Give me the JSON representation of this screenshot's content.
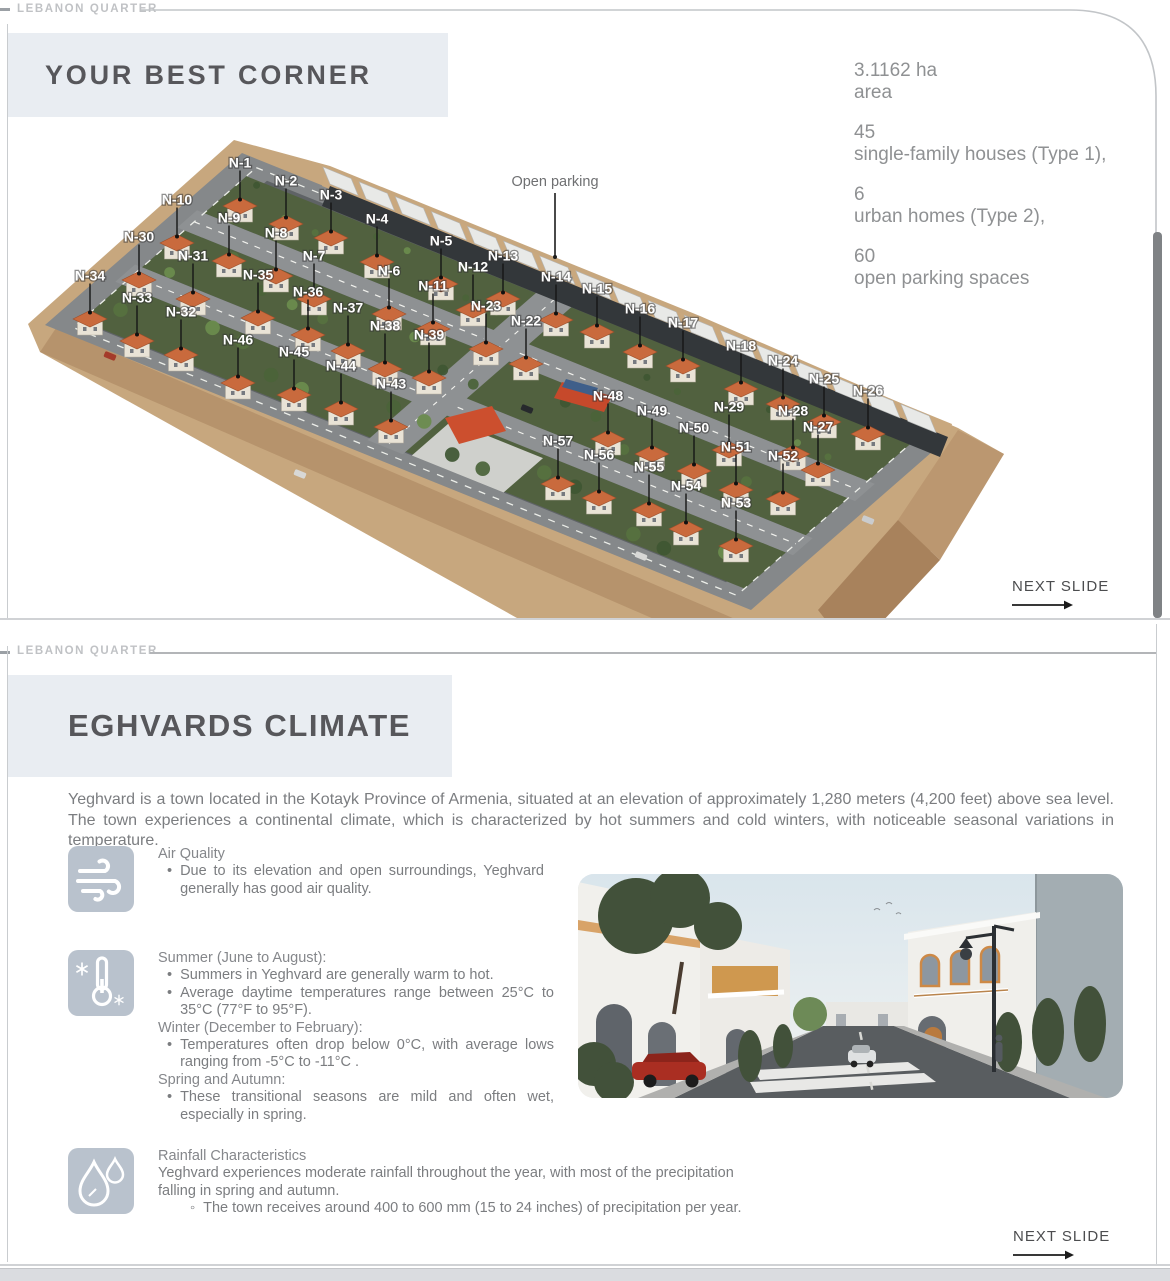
{
  "colors": {
    "title-box-bg": "#e9edf2",
    "brand-text": "#c0c2c5",
    "frame-line": "#c9cccf",
    "heading-text": "#57575b",
    "stats-text": "#8f9193",
    "body-text": "#7b7d80",
    "icon-box-bg": "#b9c2cd",
    "roof-orange": "#c96a3d",
    "terrain-tan": "#c7a77e",
    "asphalt-gray": "#5f6366",
    "scrollbar": "#7f8285",
    "next-slide-text": "#4c4d4f"
  },
  "slide1": {
    "brand": "LEBANON QUARTER",
    "title": "YOUR BEST CORNER",
    "stats": [
      {
        "value": "3.1162 ha",
        "label": "area"
      },
      {
        "value": "45",
        "label": "single-family houses (Type 1),"
      },
      {
        "value": "6",
        "label": "urban homes (Type 2),"
      },
      {
        "value": "60",
        "label": "open parking spaces"
      }
    ],
    "map": {
      "annotation": "Open parking",
      "lots": [
        {
          "label": "N-1",
          "x": 240,
          "y": 163
        },
        {
          "label": "N-10",
          "x": 177,
          "y": 200
        },
        {
          "label": "N-2",
          "x": 286,
          "y": 181
        },
        {
          "label": "N-3",
          "x": 331,
          "y": 195
        },
        {
          "label": "N-9",
          "x": 229,
          "y": 218
        },
        {
          "label": "N-4",
          "x": 377,
          "y": 219
        },
        {
          "label": "N-8",
          "x": 276,
          "y": 233
        },
        {
          "label": "N-30",
          "x": 139,
          "y": 237
        },
        {
          "label": "N-5",
          "x": 441,
          "y": 241
        },
        {
          "label": "N-31",
          "x": 193,
          "y": 256
        },
        {
          "label": "N-7",
          "x": 314,
          "y": 256
        },
        {
          "label": "N-13",
          "x": 503,
          "y": 256
        },
        {
          "label": "N-12",
          "x": 473,
          "y": 267
        },
        {
          "label": "N-6",
          "x": 389,
          "y": 271
        },
        {
          "label": "N-35",
          "x": 258,
          "y": 275
        },
        {
          "label": "N-34",
          "x": 90,
          "y": 276
        },
        {
          "label": "N-14",
          "x": 556,
          "y": 277
        },
        {
          "label": "N-11",
          "x": 433,
          "y": 286
        },
        {
          "label": "N-15",
          "x": 597,
          "y": 289
        },
        {
          "label": "N-36",
          "x": 308,
          "y": 292
        },
        {
          "label": "N-33",
          "x": 137,
          "y": 298
        },
        {
          "label": "N-23",
          "x": 486,
          "y": 306
        },
        {
          "label": "N-37",
          "x": 348,
          "y": 308
        },
        {
          "label": "N-16",
          "x": 640,
          "y": 309
        },
        {
          "label": "N-32",
          "x": 181,
          "y": 312
        },
        {
          "label": "N-22",
          "x": 526,
          "y": 321
        },
        {
          "label": "N-17",
          "x": 683,
          "y": 323
        },
        {
          "label": "N-38",
          "x": 385,
          "y": 326
        },
        {
          "label": "N-39",
          "x": 429,
          "y": 335
        },
        {
          "label": "N-46",
          "x": 238,
          "y": 340
        },
        {
          "label": "N-18",
          "x": 741,
          "y": 346
        },
        {
          "label": "N-45",
          "x": 294,
          "y": 352
        },
        {
          "label": "N-24",
          "x": 783,
          "y": 361
        },
        {
          "label": "N-44",
          "x": 341,
          "y": 366
        },
        {
          "label": "N-25",
          "x": 824,
          "y": 379
        },
        {
          "label": "N-43",
          "x": 391,
          "y": 384
        },
        {
          "label": "N-26",
          "x": 868,
          "y": 391
        },
        {
          "label": "N-48",
          "x": 608,
          "y": 396
        },
        {
          "label": "N-29",
          "x": 729,
          "y": 407
        },
        {
          "label": "N-28",
          "x": 793,
          "y": 411
        },
        {
          "label": "N-49",
          "x": 652,
          "y": 411
        },
        {
          "label": "N-27",
          "x": 818,
          "y": 427
        },
        {
          "label": "N-50",
          "x": 694,
          "y": 428
        },
        {
          "label": "N-57",
          "x": 558,
          "y": 441
        },
        {
          "label": "N-51",
          "x": 736,
          "y": 447
        },
        {
          "label": "N-56",
          "x": 599,
          "y": 455
        },
        {
          "label": "N-52",
          "x": 783,
          "y": 456
        },
        {
          "label": "N-55",
          "x": 649,
          "y": 467
        },
        {
          "label": "N-54",
          "x": 686,
          "y": 486
        },
        {
          "label": "N-53",
          "x": 736,
          "y": 503
        }
      ]
    },
    "next": "NEXT SLIDE"
  },
  "slide2": {
    "brand": "LEBANON QUARTER",
    "title": "EGHVARDS CLIMATE",
    "intro": "Yeghvard is a town located in the Kotayk Province of Armenia, situated at an elevation of approximately 1,280 meters (4,200 feet) above sea level. The town experiences a continental climate, which is characterized by hot summers and cold winters, with noticeable seasonal variations in temperature.",
    "sections": [
      {
        "icon": "wind-icon",
        "lines": [
          {
            "k": "h",
            "text": "Air Quality"
          },
          {
            "k": "b",
            "text": "Due to its elevation and open surroundings, Yeghvard generally has good air quality."
          }
        ]
      },
      {
        "icon": "thermometer-icon",
        "lines": [
          {
            "k": "h",
            "text": "Summer (June to August):"
          },
          {
            "k": "b",
            "text": "Summers in Yeghvard are generally warm to hot."
          },
          {
            "k": "b",
            "text": "Average daytime temperatures range between 25°C to 35°C (77°F to 95°F)."
          },
          {
            "k": "h",
            "text": "Winter (December to February):"
          },
          {
            "k": "b",
            "text": "Temperatures often drop below 0°C, with average lows ranging from -5°C to -11°C ."
          },
          {
            "k": "h",
            "text": "Spring and Autumn:"
          },
          {
            "k": "b",
            "text": "These transitional seasons are mild and often wet, especially in spring."
          }
        ]
      },
      {
        "icon": "rain-icon",
        "lines": [
          {
            "k": "h",
            "text": "Rainfall Characteristics"
          },
          {
            "k": "t",
            "text": "Yeghvard experiences moderate rainfall throughout the year, with most of the precipitation falling in spring and autumn."
          },
          {
            "k": "o",
            "text": "The town receives around 400 to 600 mm (15 to 24 inches) of precipitation per year."
          }
        ]
      }
    ],
    "next": "NEXT SLIDE"
  }
}
